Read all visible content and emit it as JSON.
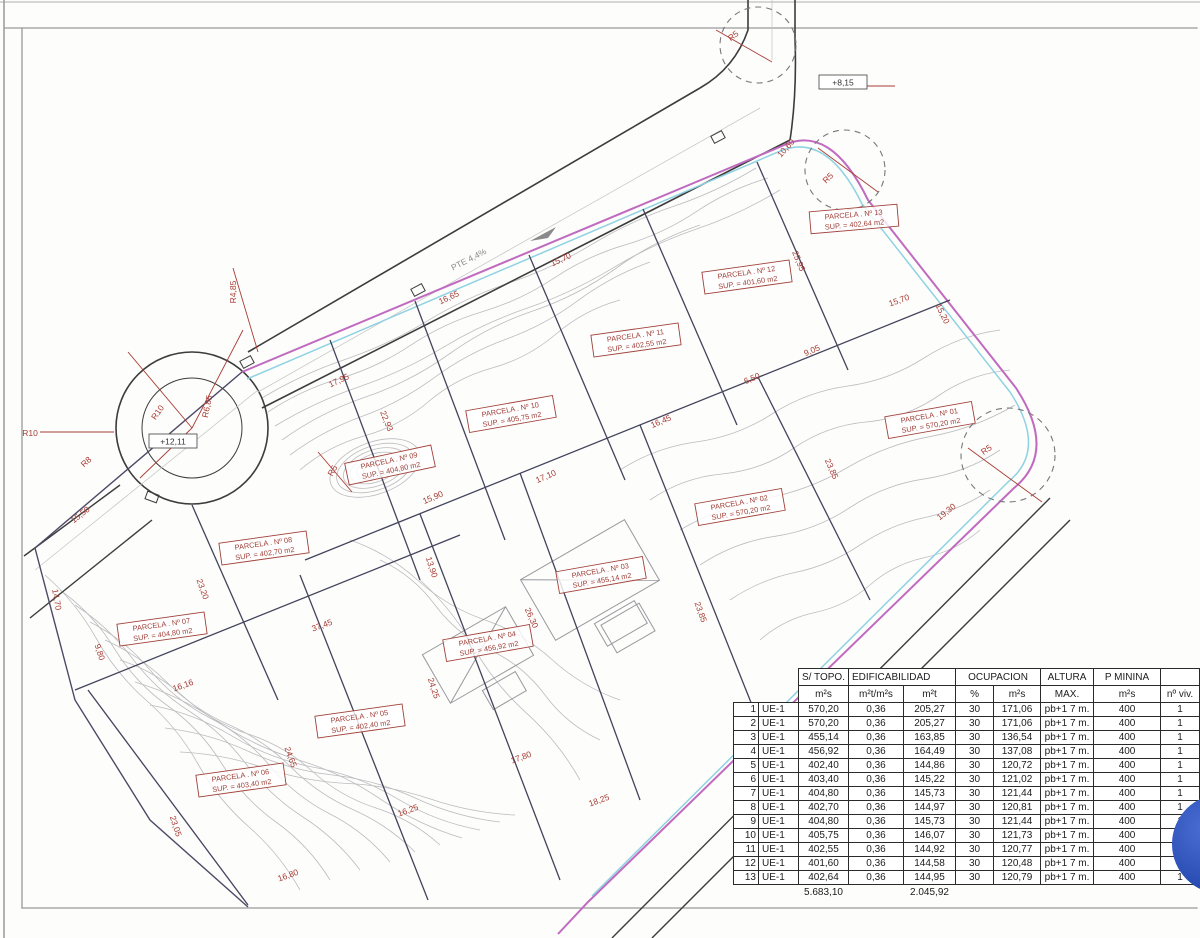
{
  "colors": {
    "boundary_magenta": "#c06ac0",
    "boundary_cyan": "#8fd2e2",
    "annotation_red": "#a83c34",
    "division_dark": "#43435c",
    "contour_gray": "#bcbcc0",
    "watermark_blue": "#2d51b8"
  },
  "plan": {
    "levels": [
      {
        "text": "+12,11",
        "x": 173,
        "y": 441
      },
      {
        "text": "+8,15",
        "x": 843,
        "y": 82
      }
    ],
    "dimensions": [
      {
        "text": "R4,85",
        "x": 236,
        "y": 292,
        "rot": -90
      },
      {
        "text": "R10",
        "x": 30,
        "y": 436,
        "rot": 0
      },
      {
        "text": "R10",
        "x": 160,
        "y": 414,
        "rot": -55
      },
      {
        "text": "R6,85",
        "x": 210,
        "y": 407,
        "rot": -78
      },
      {
        "text": "R8",
        "x": 88,
        "y": 464,
        "rot": -42
      },
      {
        "text": "R5",
        "x": 335,
        "y": 472,
        "rot": -60
      },
      {
        "text": "R5",
        "x": 735,
        "y": 38,
        "rot": -38
      },
      {
        "text": "R5",
        "x": 830,
        "y": 180,
        "rot": -45
      },
      {
        "text": "R5",
        "x": 988,
        "y": 452,
        "rot": -35
      },
      {
        "text": "PTE 4,4%",
        "x": 470,
        "y": 262,
        "rot": -27
      },
      {
        "text": "16,65",
        "x": 450,
        "y": 300,
        "rot": -25
      },
      {
        "text": "15,70",
        "x": 562,
        "y": 262,
        "rot": -25
      },
      {
        "text": "10,60",
        "x": 788,
        "y": 150,
        "rot": -48
      },
      {
        "text": "25,95",
        "x": 796,
        "y": 262,
        "rot": 68
      },
      {
        "text": "15,70",
        "x": 900,
        "y": 303,
        "rot": -20
      },
      {
        "text": "15,20",
        "x": 940,
        "y": 315,
        "rot": 64
      },
      {
        "text": "9,05",
        "x": 813,
        "y": 353,
        "rot": -23
      },
      {
        "text": "6,50",
        "x": 753,
        "y": 381,
        "rot": -23
      },
      {
        "text": "16,45",
        "x": 662,
        "y": 424,
        "rot": -23
      },
      {
        "text": "17,10",
        "x": 547,
        "y": 479,
        "rot": -23
      },
      {
        "text": "15,90",
        "x": 434,
        "y": 500,
        "rot": -23
      },
      {
        "text": "22,93",
        "x": 384,
        "y": 422,
        "rot": 68
      },
      {
        "text": "17,95",
        "x": 340,
        "y": 383,
        "rot": -25
      },
      {
        "text": "15,50",
        "x": 82,
        "y": 517,
        "rot": -38
      },
      {
        "text": "14,70",
        "x": 54,
        "y": 600,
        "rot": 80
      },
      {
        "text": "23,20",
        "x": 200,
        "y": 590,
        "rot": 70
      },
      {
        "text": "9,80",
        "x": 97,
        "y": 653,
        "rot": 72
      },
      {
        "text": "16,16",
        "x": 184,
        "y": 688,
        "rot": -20
      },
      {
        "text": "37,45",
        "x": 323,
        "y": 628,
        "rot": -20
      },
      {
        "text": "13,90",
        "x": 429,
        "y": 568,
        "rot": 72
      },
      {
        "text": "24,25",
        "x": 431,
        "y": 689,
        "rot": 72
      },
      {
        "text": "26,30",
        "x": 529,
        "y": 619,
        "rot": 66
      },
      {
        "text": "24,65",
        "x": 288,
        "y": 758,
        "rot": 70
      },
      {
        "text": "16,25",
        "x": 409,
        "y": 813,
        "rot": -20
      },
      {
        "text": "17,80",
        "x": 522,
        "y": 760,
        "rot": -20
      },
      {
        "text": "18,25",
        "x": 600,
        "y": 803,
        "rot": -20
      },
      {
        "text": "16,80",
        "x": 289,
        "y": 878,
        "rot": -20
      },
      {
        "text": "23,05",
        "x": 173,
        "y": 827,
        "rot": 72
      },
      {
        "text": "23,85",
        "x": 829,
        "y": 470,
        "rot": 66
      },
      {
        "text": "19,30",
        "x": 948,
        "y": 514,
        "rot": -38
      },
      {
        "text": "23,85",
        "x": 698,
        "y": 613,
        "rot": 70
      }
    ],
    "parcels": [
      {
        "line1": "PARCELA . Nº 01",
        "line2": "SUP. = 570,20 m2",
        "x": 930,
        "y": 420,
        "rot": -10
      },
      {
        "line1": "PARCELA . Nº 02",
        "line2": "SUP. = 570,20 m2",
        "x": 740,
        "y": 507,
        "rot": -10
      },
      {
        "line1": "PARCELA . Nº 03",
        "line2": "SUP. = 455,14 m2",
        "x": 601,
        "y": 575,
        "rot": -10
      },
      {
        "line1": "PARCELA . Nº 04",
        "line2": "SUP. = 456,92 m2",
        "x": 488,
        "y": 643,
        "rot": -10
      },
      {
        "line1": "PARCELA . Nº 05",
        "line2": "SUP. = 402,40 m2",
        "x": 360,
        "y": 721,
        "rot": -8
      },
      {
        "line1": "PARCELA . Nº 06",
        "line2": "SUP. = 403,40 m2",
        "x": 241,
        "y": 780,
        "rot": -8
      },
      {
        "line1": "PARCELA . Nº 07",
        "line2": "SUP. = 404,80 m2",
        "x": 162,
        "y": 629,
        "rot": -8
      },
      {
        "line1": "PARCELA . Nº 08",
        "line2": "SUP. = 402,70 m2",
        "x": 264,
        "y": 548,
        "rot": -8
      },
      {
        "line1": "PARCELA . Nº 09",
        "line2": "SUP. = 404,80 m2",
        "x": 390,
        "y": 465,
        "rot": -12
      },
      {
        "line1": "PARCELA . Nº 10",
        "line2": "SUP. = 405,75 m2",
        "x": 511,
        "y": 414,
        "rot": -10
      },
      {
        "line1": "PARCELA . Nº 11",
        "line2": "SUP. = 402,55 m2",
        "x": 636,
        "y": 340,
        "rot": -8
      },
      {
        "line1": "PARCELA . Nº 12",
        "line2": "SUP. = 401,60 m2",
        "x": 747,
        "y": 277,
        "rot": -8
      },
      {
        "line1": "PARCELA . Nº 13",
        "line2": "SUP. = 402,64 m2",
        "x": 854,
        "y": 219,
        "rot": -5
      }
    ]
  },
  "table": {
    "groups": {
      "s_topo": "S/ TOPO.",
      "edificabilidad": "EDIFICABILIDAD",
      "ocupacion": "OCUPACION",
      "altura": "ALTURA",
      "p_minina": "P MININA"
    },
    "units": [
      "m²s",
      "m²t/m²s",
      "m²t",
      "%",
      "m²s",
      "MAX.",
      "m²s",
      "nº viv."
    ],
    "rows": [
      [
        "1",
        "UE-1",
        "570,20",
        "0,36",
        "205,27",
        "30",
        "171,06",
        "pb+1 7 m.",
        "400",
        "1"
      ],
      [
        "2",
        "UE-1",
        "570,20",
        "0,36",
        "205,27",
        "30",
        "171,06",
        "pb+1 7 m.",
        "400",
        "1"
      ],
      [
        "3",
        "UE-1",
        "455,14",
        "0,36",
        "163,85",
        "30",
        "136,54",
        "pb+1 7 m.",
        "400",
        "1"
      ],
      [
        "4",
        "UE-1",
        "456,92",
        "0,36",
        "164,49",
        "30",
        "137,08",
        "pb+1 7 m.",
        "400",
        "1"
      ],
      [
        "5",
        "UE-1",
        "402,40",
        "0,36",
        "144,86",
        "30",
        "120,72",
        "pb+1 7 m.",
        "400",
        "1"
      ],
      [
        "6",
        "UE-1",
        "403,40",
        "0,36",
        "145,22",
        "30",
        "121,02",
        "pb+1 7 m.",
        "400",
        "1"
      ],
      [
        "7",
        "UE-1",
        "404,80",
        "0,36",
        "145,73",
        "30",
        "121,44",
        "pb+1 7 m.",
        "400",
        "1"
      ],
      [
        "8",
        "UE-1",
        "402,70",
        "0,36",
        "144,97",
        "30",
        "120,81",
        "pb+1 7 m.",
        "400",
        "1"
      ],
      [
        "9",
        "UE-1",
        "404,80",
        "0,36",
        "145,73",
        "30",
        "121,44",
        "pb+1 7 m.",
        "400",
        "1"
      ],
      [
        "10",
        "UE-1",
        "405,75",
        "0,36",
        "146,07",
        "30",
        "121,73",
        "pb+1 7 m.",
        "400",
        "1"
      ],
      [
        "11",
        "UE-1",
        "402,55",
        "0,36",
        "144,92",
        "30",
        "120,77",
        "pb+1 7 m.",
        "400",
        "1"
      ],
      [
        "12",
        "UE-1",
        "401,60",
        "0,36",
        "144,58",
        "30",
        "120,48",
        "pb+1 7 m.",
        "400",
        "1"
      ],
      [
        "13",
        "UE-1",
        "402,64",
        "0,36",
        "144,95",
        "30",
        "120,79",
        "pb+1 7 m.",
        "400",
        "1"
      ]
    ],
    "totals": {
      "s_topo": "5.683,10",
      "m2t": "2.045,92"
    }
  }
}
